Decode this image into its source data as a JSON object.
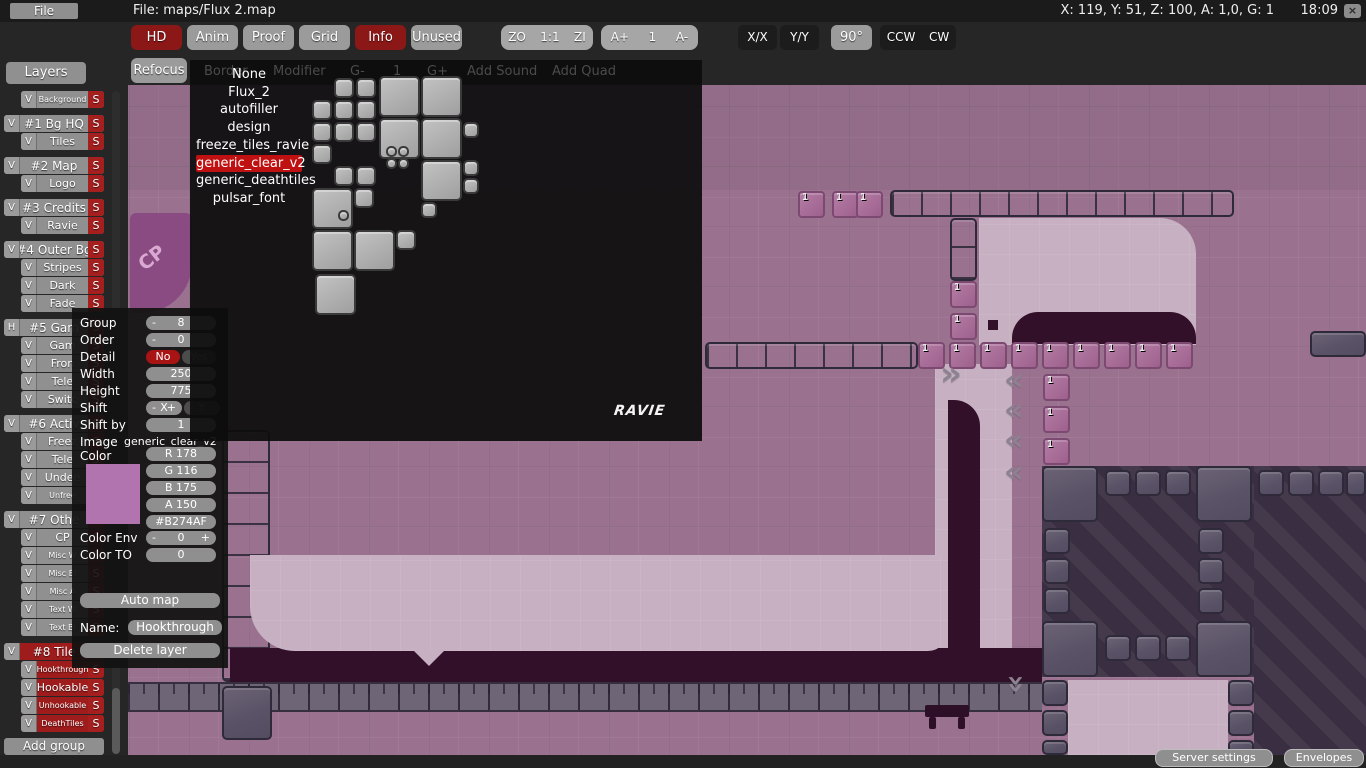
{
  "topbar": {
    "file_menu": "File",
    "title": "File: maps/Flux 2.map",
    "status": "X: 119, Y: 51, Z: 100, A: 1,0, G: 1",
    "clock": "18:09",
    "close_label": "×"
  },
  "toolbar": {
    "toggles": [
      {
        "label": "HD",
        "active": true
      },
      {
        "label": "Anim",
        "active": false
      },
      {
        "label": "Proof",
        "active": false
      },
      {
        "label": "Grid",
        "active": false
      },
      {
        "label": "Info",
        "active": true
      },
      {
        "label": "Unused",
        "active": false
      }
    ],
    "zoom_group": [
      "ZO",
      "1:1",
      "ZI"
    ],
    "anim_group": [
      "A+",
      "1",
      "A-"
    ],
    "flip_buttons": [
      "X/X",
      "Y/Y"
    ],
    "rotate_button": "90°",
    "rotation_buttons": [
      "CCW",
      "CW"
    ],
    "refocus": "Refocus",
    "ghost_buttons": [
      "Border",
      "Modifier",
      "G-",
      "1",
      "G+",
      "Add Sound",
      "Add Quad"
    ]
  },
  "layers_panel": {
    "header": "Layers",
    "add_group": "Add group",
    "rows": [
      {
        "label": "Background",
        "group": false,
        "small": true,
        "toggle": "V",
        "selected": false
      },
      {
        "label": "#1 Bg HQ",
        "group": true,
        "small": false,
        "toggle": "V",
        "selected": false
      },
      {
        "label": "Tiles",
        "group": false,
        "small": false,
        "toggle": "V",
        "selected": false
      },
      {
        "label": "#2 Map",
        "group": true,
        "small": false,
        "toggle": "V",
        "selected": false
      },
      {
        "label": "Logo",
        "group": false,
        "small": false,
        "toggle": "V",
        "selected": false
      },
      {
        "label": "#3 Credits",
        "group": true,
        "small": false,
        "toggle": "V",
        "selected": false
      },
      {
        "label": "Ravie",
        "group": false,
        "small": false,
        "toggle": "V",
        "selected": false
      },
      {
        "label": "#4 Outer Bg",
        "group": true,
        "small": false,
        "toggle": "V",
        "selected": false
      },
      {
        "label": "Stripes",
        "group": false,
        "small": false,
        "toggle": "V",
        "selected": false
      },
      {
        "label": "Dark",
        "group": false,
        "small": false,
        "toggle": "V",
        "selected": false
      },
      {
        "label": "Fade",
        "group": false,
        "small": false,
        "toggle": "V",
        "selected": false
      },
      {
        "label": "#5 Gam",
        "group": true,
        "small": false,
        "toggle": "H",
        "selected": false
      },
      {
        "label": "Gam",
        "group": false,
        "small": false,
        "toggle": "V",
        "selected": false
      },
      {
        "label": "Fron",
        "group": false,
        "small": false,
        "toggle": "V",
        "selected": false
      },
      {
        "label": "Tele",
        "group": false,
        "small": false,
        "toggle": "V",
        "selected": false
      },
      {
        "label": "Switc",
        "group": false,
        "small": false,
        "toggle": "V",
        "selected": false
      },
      {
        "label": "#6 Activ",
        "group": true,
        "small": false,
        "toggle": "V",
        "selected": false
      },
      {
        "label": "Freez",
        "group": false,
        "small": false,
        "toggle": "V",
        "selected": false
      },
      {
        "label": "Tele",
        "group": false,
        "small": false,
        "toggle": "V",
        "selected": false
      },
      {
        "label": "Undee",
        "group": false,
        "small": false,
        "toggle": "V",
        "selected": false
      },
      {
        "label": "Unfree",
        "group": false,
        "small": true,
        "toggle": "V",
        "selected": false
      },
      {
        "label": "#7 Othe",
        "group": true,
        "small": false,
        "toggle": "V",
        "selected": false
      },
      {
        "label": "CP",
        "group": false,
        "small": false,
        "toggle": "V",
        "selected": false
      },
      {
        "label": "Misc W",
        "group": false,
        "small": true,
        "toggle": "V",
        "selected": false
      },
      {
        "label": "Misc Bl",
        "group": false,
        "small": true,
        "toggle": "V",
        "selected": false
      },
      {
        "label": "Misc A",
        "group": false,
        "small": true,
        "toggle": "V",
        "selected": false
      },
      {
        "label": "Text W",
        "group": false,
        "small": true,
        "toggle": "V",
        "selected": false
      },
      {
        "label": "Text Bl",
        "group": false,
        "small": true,
        "toggle": "V",
        "selected": false
      },
      {
        "label": "#8 Tile",
        "group": true,
        "small": false,
        "toggle": "V",
        "selected": true
      },
      {
        "label": "Hookthrough",
        "group": false,
        "small": true,
        "toggle": "V",
        "selected": true
      },
      {
        "label": "Hookable",
        "group": false,
        "small": false,
        "toggle": "V",
        "selected": true
      },
      {
        "label": "Unhookable",
        "group": false,
        "small": true,
        "toggle": "V",
        "selected": true
      },
      {
        "label": "DeathTiles",
        "group": false,
        "small": true,
        "toggle": "V",
        "selected": true
      }
    ],
    "solo_flag": "S"
  },
  "image_popup": {
    "items": [
      "None",
      "Flux_2",
      "autofiller",
      "design",
      "freeze_tiles_ravie",
      "generic_clear_v2",
      "generic_deathtiles",
      "pulsar_font"
    ],
    "selected": "generic_clear_v2",
    "watermark": "RAVIE"
  },
  "layer_props": {
    "group_label": "Group",
    "group_value": "8",
    "order_label": "Order",
    "order_value": "0",
    "detail_label": "Detail",
    "detail_no": "No",
    "detail_yes": "Yes",
    "width_label": "Width",
    "width_value": "250",
    "height_label": "Height",
    "height_value": "775",
    "shift_label": "Shift",
    "shift_x": "X",
    "shift_y": "Y",
    "shiftby_label": "Shift by",
    "shiftby_value": "1",
    "image_label": "Image",
    "image_value": "generic_clear_v2",
    "minus": "-",
    "plus": "+",
    "color_label": "Color",
    "color": {
      "swatch": "#B274AF",
      "r": "R 178",
      "g": "G 116",
      "b": "B 175",
      "a": "A 150",
      "hex": "#B274AF"
    },
    "color_env_label": "Color Env",
    "color_env_value": "0",
    "color_to_label": "Color TO",
    "color_to_value": "0",
    "auto_map": "Auto map",
    "name_label": "Name:",
    "name_value": "Hookthrough",
    "delete_layer": "Delete layer"
  },
  "statusbar": {
    "server_settings": "Server settings",
    "envelopes": "Envelopes"
  },
  "canvas": {
    "cp_label": "CP",
    "tile_number": "1",
    "badges": [
      {
        "x": 670,
        "y": 106
      },
      {
        "x": 704,
        "y": 106
      },
      {
        "x": 728,
        "y": 106
      },
      {
        "x": 822,
        "y": 196
      },
      {
        "x": 822,
        "y": 228
      },
      {
        "x": 790,
        "y": 257
      },
      {
        "x": 821,
        "y": 257
      },
      {
        "x": 852,
        "y": 257
      },
      {
        "x": 883,
        "y": 257
      },
      {
        "x": 914,
        "y": 257
      },
      {
        "x": 945,
        "y": 257
      },
      {
        "x": 976,
        "y": 257
      },
      {
        "x": 1007,
        "y": 257
      },
      {
        "x": 1038,
        "y": 257
      },
      {
        "x": 915,
        "y": 289
      },
      {
        "x": 915,
        "y": 321
      },
      {
        "x": 915,
        "y": 353
      }
    ],
    "chevrons": [
      {
        "x": 812,
        "y": 276,
        "dir": "right"
      },
      {
        "x": 876,
        "y": 283,
        "dir": "left"
      },
      {
        "x": 876,
        "y": 313,
        "dir": "left"
      },
      {
        "x": 876,
        "y": 343,
        "dir": "left"
      },
      {
        "x": 876,
        "y": 375,
        "dir": "left"
      },
      {
        "x": 878,
        "y": 586,
        "dir": "down"
      }
    ]
  }
}
